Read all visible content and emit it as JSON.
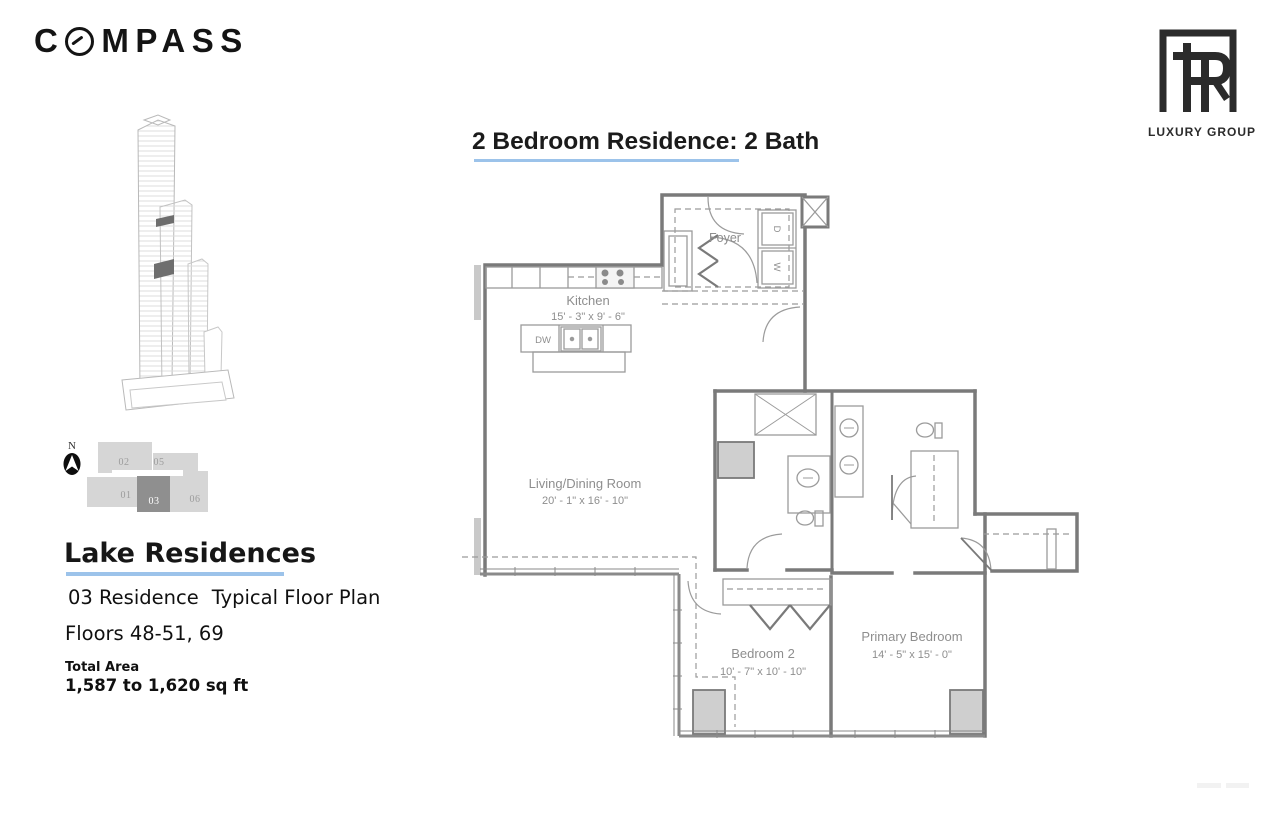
{
  "header": {
    "compass_pre": "C",
    "compass_post": "MPASS",
    "luxury_group": "LUXURY GROUP"
  },
  "title": "2 Bedroom Residence: 2 Bath",
  "sidebar": {
    "building_name": "Lake Residences",
    "residence": "03 Residence",
    "plan_type": "Typical Floor Plan",
    "floors": "Floors 48-51, 69",
    "total_area_label": "Total Area",
    "total_area_value": "1,587 to 1,620 sq ft",
    "north_label": "N"
  },
  "keyplan": {
    "highlighted_unit": "03",
    "units": [
      {
        "label": "02"
      },
      {
        "label": "05"
      },
      {
        "label": "01"
      },
      {
        "label": "03"
      },
      {
        "label": "06"
      }
    ]
  },
  "plan": {
    "foyer": {
      "name": "Foyer"
    },
    "kitchen": {
      "name": "Kitchen",
      "dims": "15' - 3\" x 9' - 6\""
    },
    "living": {
      "name": "Living/Dining Room",
      "dims": "20' - 1\" x 16' - 10\""
    },
    "bedroom2": {
      "name": "Bedroom 2",
      "dims": "10' - 7\" x 10' - 10\""
    },
    "primary": {
      "name": "Primary Bedroom",
      "dims": "14' - 5\" x 15' - 0\""
    },
    "labels": {
      "dw": "DW",
      "washer": "W",
      "dryer": "D"
    }
  },
  "colors": {
    "accent_underline": "#9cc3ea",
    "wall_gray": "#7a7a7a",
    "room_label_gray": "#8e8e8e",
    "keyplan_light": "#d6d6d6",
    "keyplan_dark": "#8f8f8f",
    "column_fill": "#cfcfcf"
  }
}
